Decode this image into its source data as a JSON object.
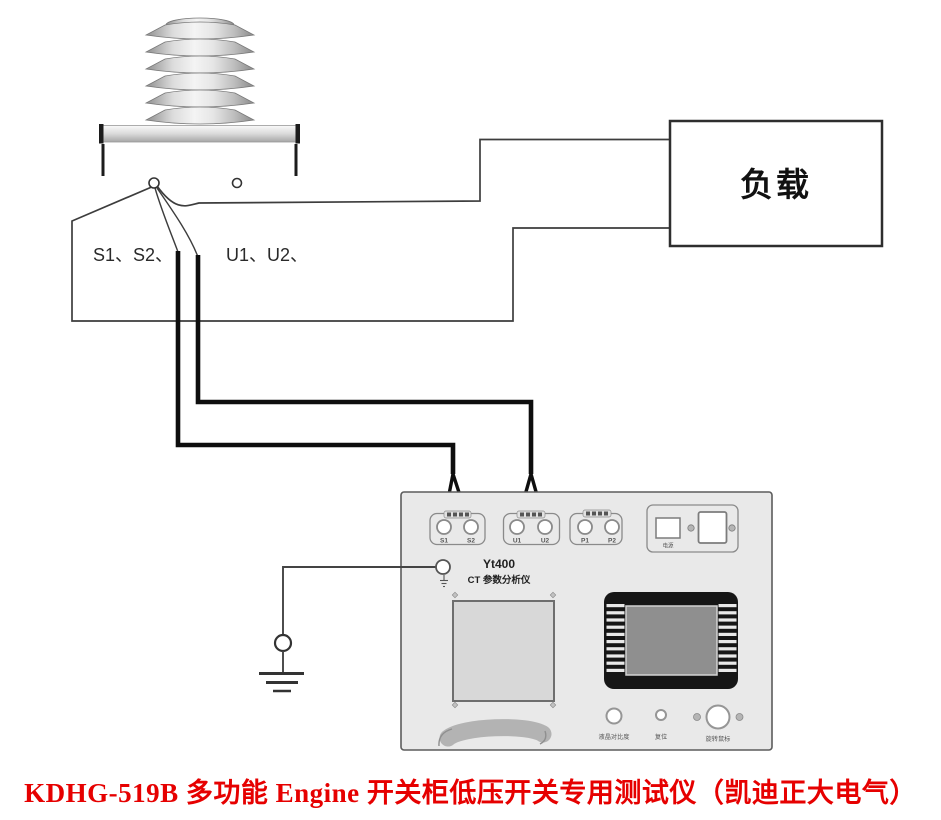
{
  "ct": {
    "secondary_label": "S1、S2、",
    "primary_label": "U1、U2、"
  },
  "load": {
    "label": "负载"
  },
  "device": {
    "model": "Yt400",
    "name": "CT 参数分析仪",
    "terminals": [
      {
        "group": "s",
        "labels": [
          "S1",
          "S2"
        ]
      },
      {
        "group": "u",
        "labels": [
          "U1",
          "U2"
        ]
      },
      {
        "group": "p",
        "labels": [
          "P1",
          "P2"
        ]
      }
    ],
    "power_label": "电源",
    "controls": [
      {
        "label": "液晶对比度"
      },
      {
        "label": "复位"
      },
      {
        "label": "旋转鼠标"
      }
    ]
  },
  "caption": {
    "text": "KDHG-519B 多功能 Engine 开关柜低压开关专用测试仪（凯迪正大电气）",
    "color": "#e60000"
  }
}
